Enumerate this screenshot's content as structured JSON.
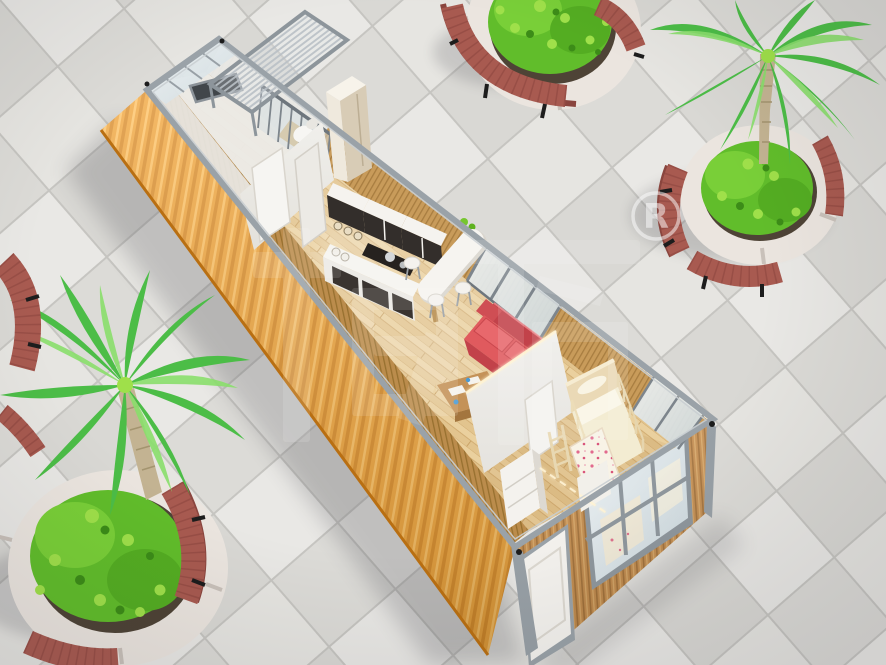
{
  "watermark": {
    "characters": "柜族",
    "registered": "®"
  },
  "scene": {
    "description": "Aerial 3D cutaway rendering of a single-unit container house placed on a tiled plaza",
    "objects": [
      "container house with open top showing interior",
      "orange corrugated side wall",
      "timber slat end wall with white entry door and large window",
      "porch with slatted glass roof",
      "bathroom with glass shower enclosure",
      "kitchen cabinets with cooktop and bar table with stools",
      "red sofa and wooden coffee table",
      "bedroom with bunk bed, ladder and floral quilt",
      "four round stone planters with curved red wooden benches",
      "palm trees and green shrubs"
    ]
  },
  "palette": {
    "tile_light": "#e9e8e5",
    "tile_mid": "#d9d8d4",
    "grout": "#c6c5c1",
    "orange": "#f0a133",
    "orange_dark": "#d9871f",
    "orange_deep": "#b96f12",
    "frame": "#9aa2a8",
    "frame_dark": "#6e767d",
    "siding_wood": "#c28949",
    "plank": "#ead09e",
    "slat": "#c89b5a",
    "white_wall": "#f1f0ed",
    "cabinet_dark": "#332e2b",
    "counter": "#f7f6f3",
    "sofa": "#e05a5e",
    "sofa_dark": "#c2424a",
    "table_wood": "#bf9055",
    "bed_frame": "#e9d9b5",
    "bedding": "#f4eed6",
    "quilt_pink": "#e26a8e",
    "bench": "#a85a50",
    "bench_dark": "#8a453e",
    "stone": "#ebe5df",
    "soil": "#4e4336",
    "bush": "#61bd2b",
    "bush_light": "#9fe04a",
    "palm": "#4cbd47",
    "palm_light": "#8adf6c",
    "trunk": "#c3b392",
    "glass": "#dce6ea",
    "led": "#fff3d4",
    "shadow": "#2e2e38"
  }
}
